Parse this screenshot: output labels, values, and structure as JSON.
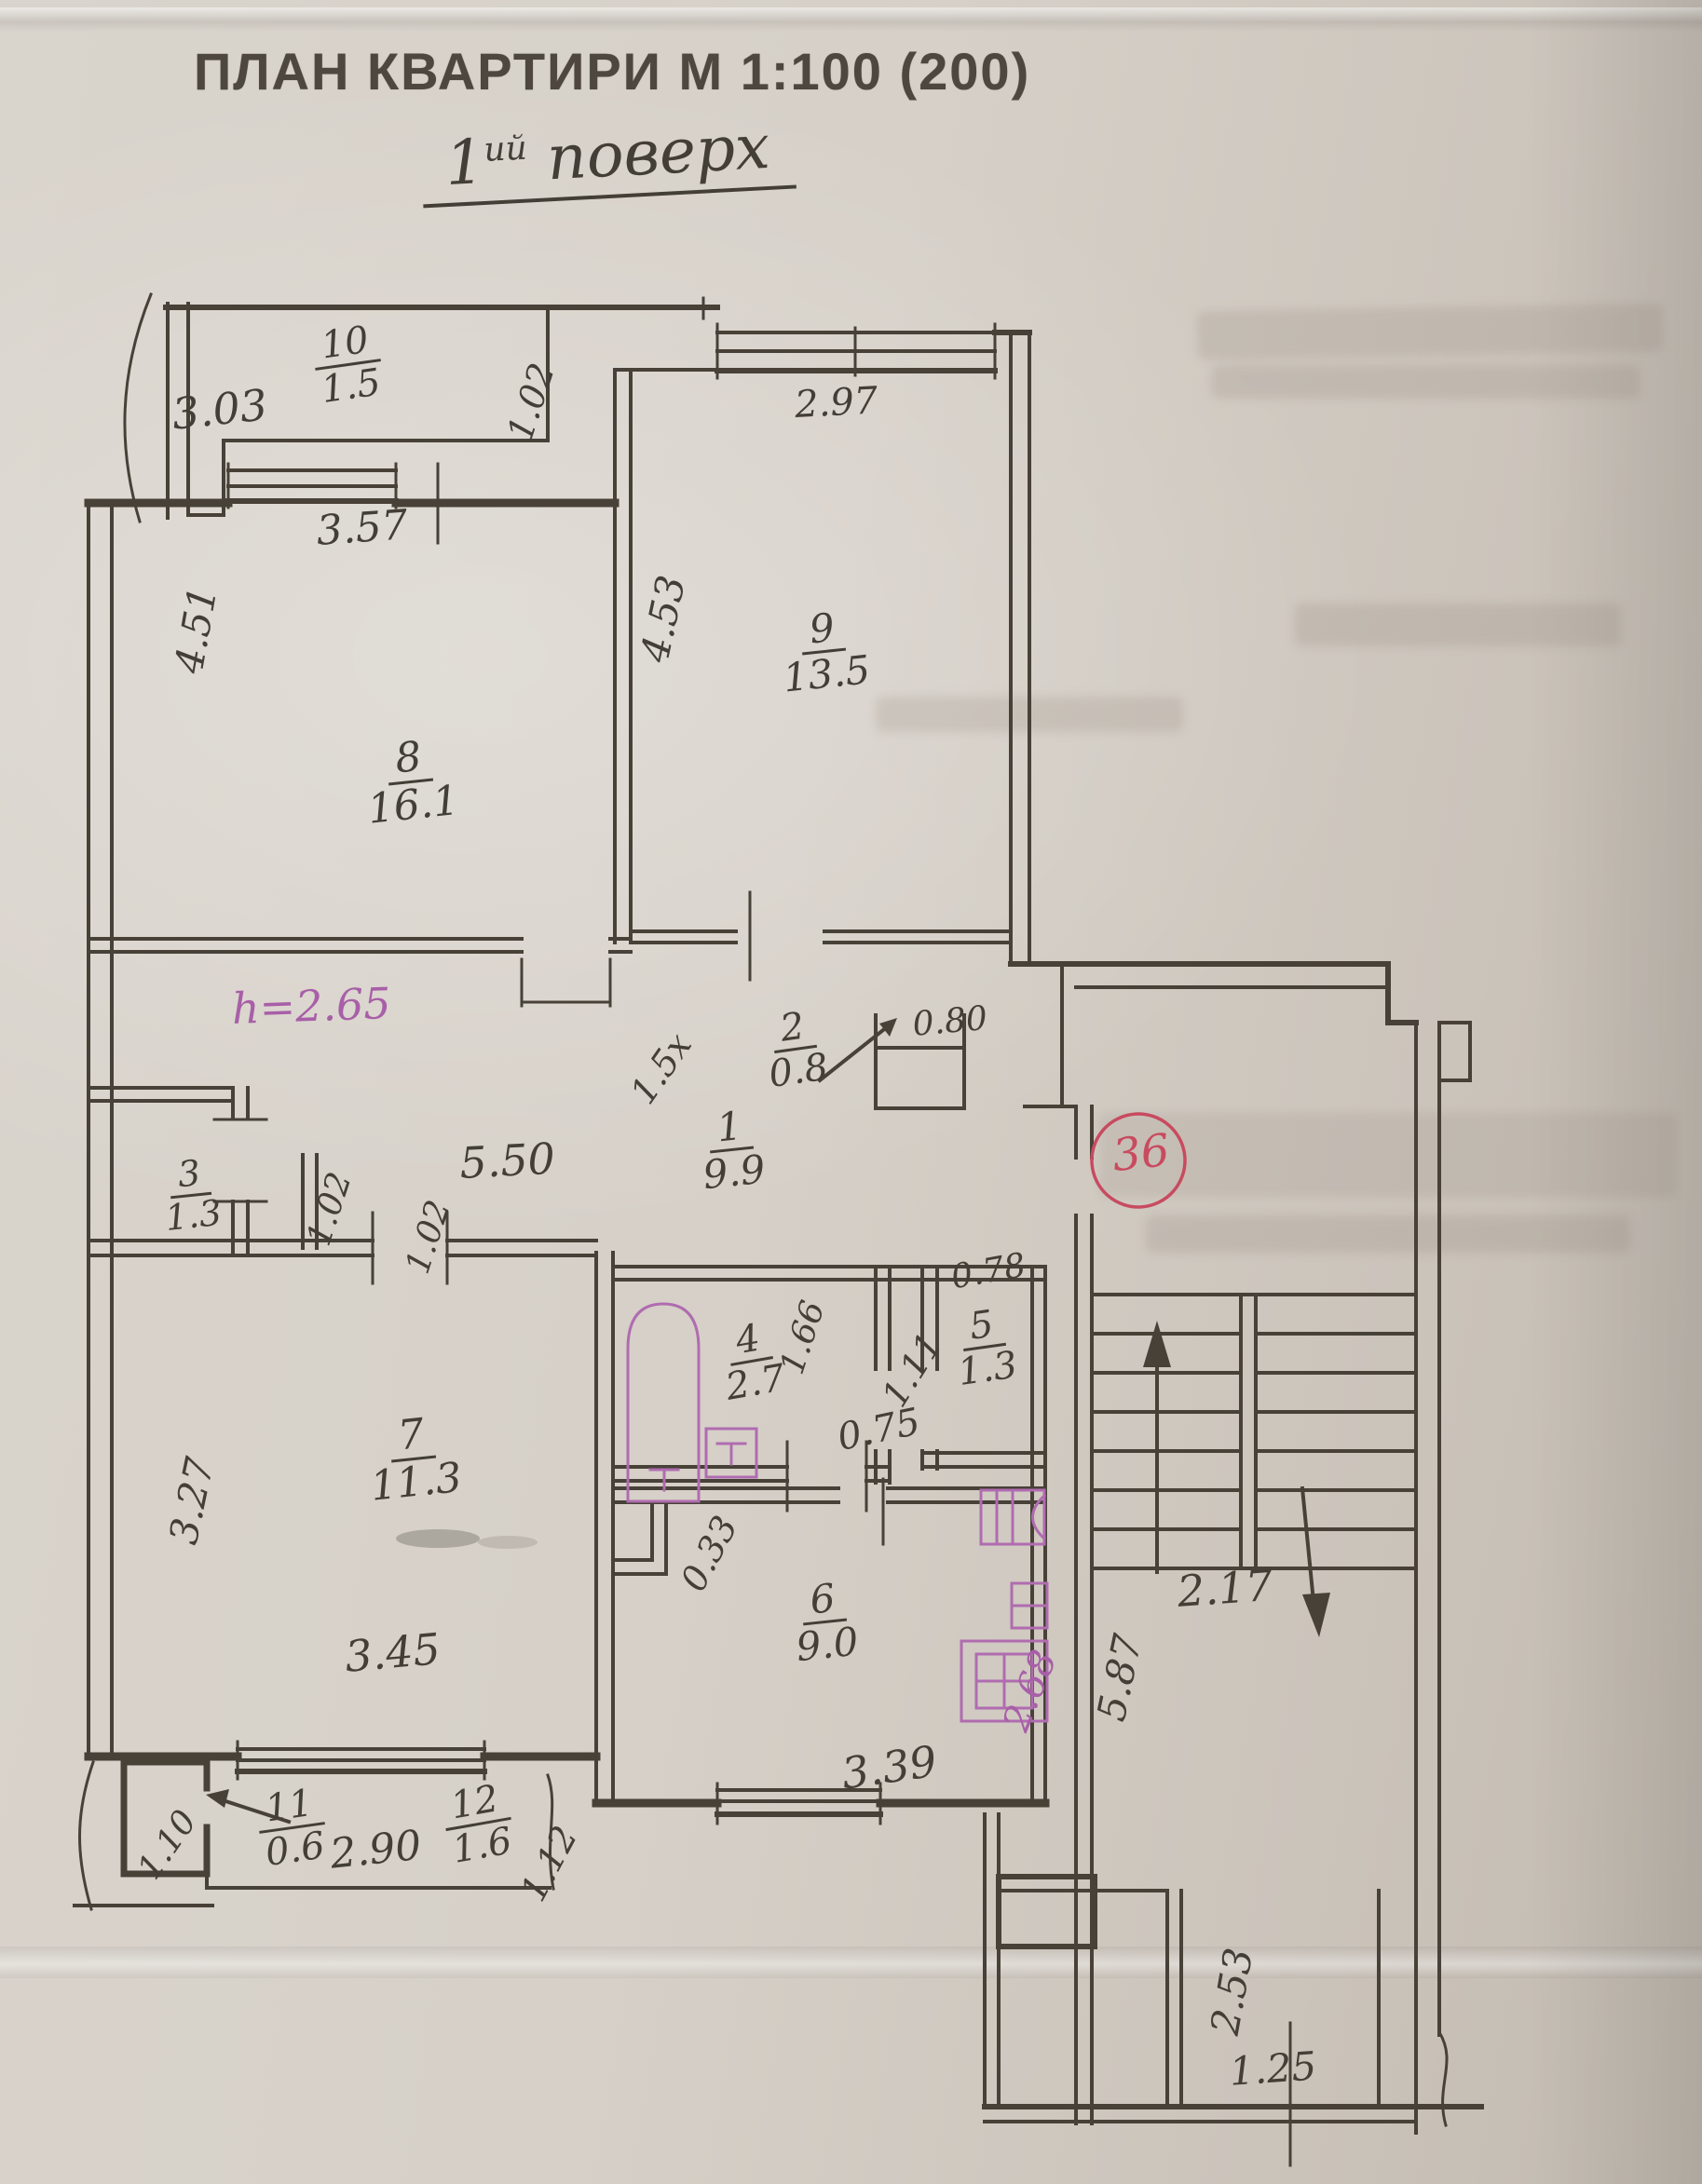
{
  "title": "ПЛАН КВАРТИРИ М 1:100 (200)",
  "subtitle": {
    "floor_number": "1",
    "floor_suffix": "ий",
    "floor_word": "поверх"
  },
  "rooms": {
    "r1": {
      "num": "1",
      "area": "9.9"
    },
    "r2": {
      "num": "2",
      "area": "0.8"
    },
    "r3": {
      "num": "3",
      "area": "1.3"
    },
    "r4": {
      "num": "4",
      "area": "2.7"
    },
    "r5": {
      "num": "5",
      "area": "1.3"
    },
    "r6": {
      "num": "6",
      "area": "9.0"
    },
    "r7": {
      "num": "7",
      "area": "11.3"
    },
    "r8": {
      "num": "8",
      "area": "16.1"
    },
    "r9": {
      "num": "9",
      "area": "13.5"
    },
    "r10": {
      "num": "10",
      "area": "1.5"
    },
    "r11": {
      "num": "11",
      "area": "0.6"
    },
    "r12": {
      "num": "12",
      "area": "1.6"
    }
  },
  "dims": {
    "balcony10_length": "3.03",
    "balcony10_depth": "1.02",
    "room8_window": "3.57",
    "room8_depth": "4.51",
    "room9_width": "2.97",
    "room9_depth": "4.53",
    "room8_door": "1.5х",
    "closet2_width": "0.80",
    "corridor_length": "5.50",
    "closet3_door": "1.02",
    "room7_door": "1.02",
    "room7_depth": "3.27",
    "room7_width": "3.45",
    "bath_depth": "1.66",
    "corridor_branch": "1.11",
    "wc_width": "0.78",
    "bath_door": "0.75",
    "kitchen_jog": "0.33",
    "kitchen_width": "3.39",
    "stair_depth": "5.87",
    "stair_width": "2.17",
    "balcony11_depth": "1.10",
    "balcony12_length": "2.90",
    "balcony12_end": "1.12",
    "vestibule_depth": "2.53",
    "vestibule_width": "1.25"
  },
  "annotations": {
    "ceiling_height": "h=2.65",
    "apartment_number": "36",
    "kitchen_note": "2.68"
  },
  "colors": {
    "ink": "#474138",
    "purple": "#a85fa8",
    "red": "#c84b60",
    "paper": "#d6d0c8"
  }
}
